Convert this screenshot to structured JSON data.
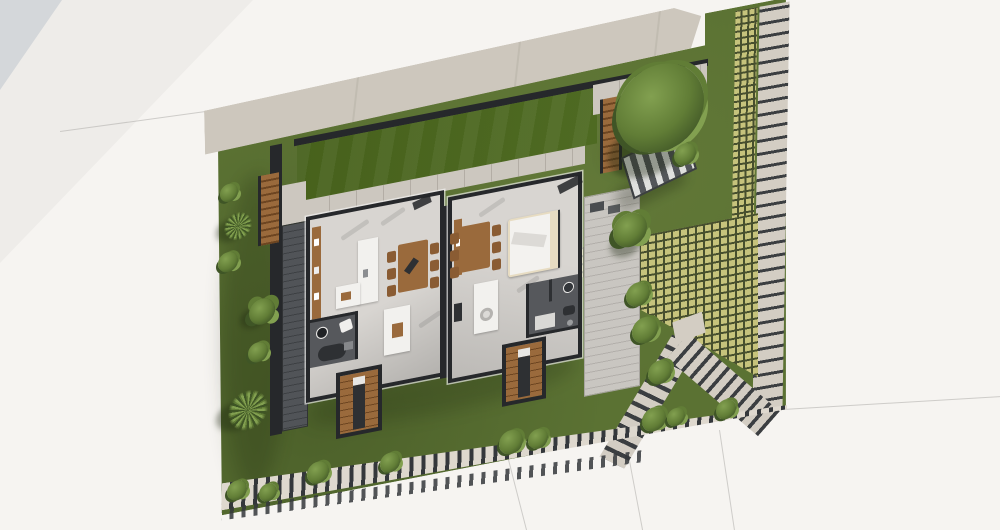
{
  "scene": {
    "kind": "3d-architectural-site-plan-render",
    "view": "aerial-top-down",
    "visible_text": "none"
  },
  "colors": {
    "page_bg": "#f6f4f1",
    "tri": "#d4d7da",
    "wedge": "#eeece9",
    "sidewalk": "#cdc7bd",
    "seam": "#b8b2a8",
    "grass": "#5b7233",
    "lawn": "#4e6a22",
    "wall": "#26282b",
    "floor": "#d8d5d1",
    "deck": "#515458",
    "deck_ln": "#3d4043",
    "wood": "#9a6a3c",
    "wood_dk": "#6d4521",
    "white_f": "#f2f1ee",
    "pillow": "#e7dcc2",
    "bath": "#56585c",
    "fixt": "#2e3033",
    "gridp": "#c6c37c",
    "gridg": "#474f2e",
    "slab": "#d3cdc3",
    "slabg": "#3b3e41",
    "wkp": "#ded8ce",
    "wkg": "#34373b",
    "terr": "#c9c6c1",
    "terr_ln": "#b2afaa",
    "pstrip": "#ccc7bf",
    "pline": "#b3ada5",
    "bline": "#b9b7b4",
    "veg": "#617d36",
    "veg_hi": "#82a050",
    "veg_dk": "#3f5526"
  },
  "site": {
    "features": [
      {
        "name": "public-sidewalk",
        "label": "Sidewalk"
      },
      {
        "name": "front-lawn",
        "label": "Front lawn"
      },
      {
        "name": "garden-lawn",
        "label": "Garden lawn"
      },
      {
        "name": "timber-deck",
        "label": "Timber deck"
      },
      {
        "name": "grass-paver-strip",
        "label": "Grass paver strip"
      },
      {
        "name": "stepping-slab-path",
        "label": "Stepping slab path"
      },
      {
        "name": "paver-grid-court",
        "label": "Paver grid court"
      },
      {
        "name": "angled-stepping-paths",
        "label": "Angled stepping paths"
      },
      {
        "name": "perimeter-stepping-walkway",
        "label": "Perimeter stepping walkway"
      },
      {
        "name": "garden-stairs",
        "label": "Garden stairs"
      },
      {
        "name": "slatted-garden-structure",
        "label": "Slatted garden structure"
      },
      {
        "name": "plot-boundary-lines",
        "label": "Plot boundary lines"
      }
    ]
  },
  "house": {
    "type": "semi-detached-single-storey-plan",
    "units": [
      {
        "id": "unit-a",
        "rooms": [
          "kitchen",
          "dining",
          "living",
          "bathroom"
        ],
        "furniture": [
          "wall-cabinets",
          "l-shaped-counter",
          "dining-table",
          "six-chairs",
          "kitchen-island",
          "bathtub",
          "washbasin",
          "toilet",
          "entry-stairs"
        ]
      },
      {
        "id": "unit-b",
        "rooms": [
          "dining",
          "bedroom",
          "living",
          "bathroom"
        ],
        "furniture": [
          "dining-table",
          "six-chairs",
          "double-bed",
          "kitchen-island",
          "washbasin",
          "shower",
          "entry-stairs"
        ]
      }
    ]
  },
  "vegetation": {
    "palm_trees": 2,
    "trees": 3,
    "shrubs": 15
  }
}
